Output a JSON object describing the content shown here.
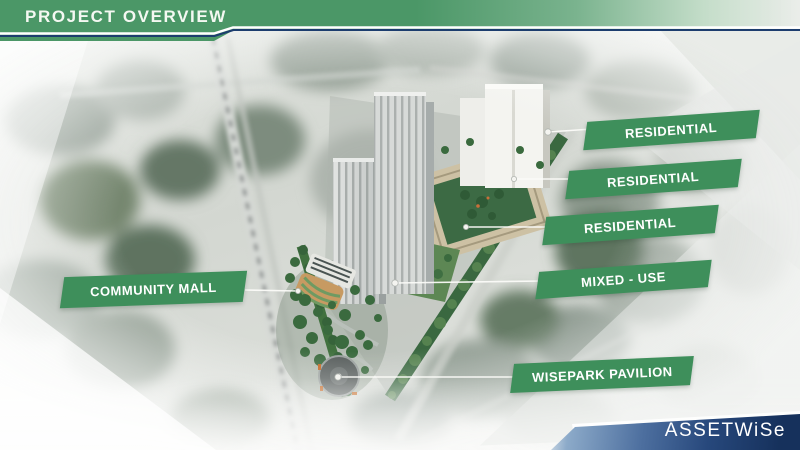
{
  "slide": {
    "title": "PROJECT OVERVIEW"
  },
  "labels": [
    {
      "id": "residential-1",
      "text": "RESIDENTIAL"
    },
    {
      "id": "residential-2",
      "text": "RESIDENTIAL"
    },
    {
      "id": "residential-3",
      "text": "RESIDENTIAL"
    },
    {
      "id": "mixed-use",
      "text": "MIXED - USE"
    },
    {
      "id": "wisepark-pavilion",
      "text": "WISEPARK PAVILION"
    },
    {
      "id": "community-mall",
      "text": "COMMUNITY MALL"
    }
  ],
  "logo": {
    "brand": "ASSETWiSe"
  },
  "colors": {
    "accent_green": "#4b9767",
    "label_green": "#3e8f5b",
    "navy_line": "#1c3d6e",
    "logo_navy": "#16315c",
    "logo_blue": "#6e8cb4"
  }
}
